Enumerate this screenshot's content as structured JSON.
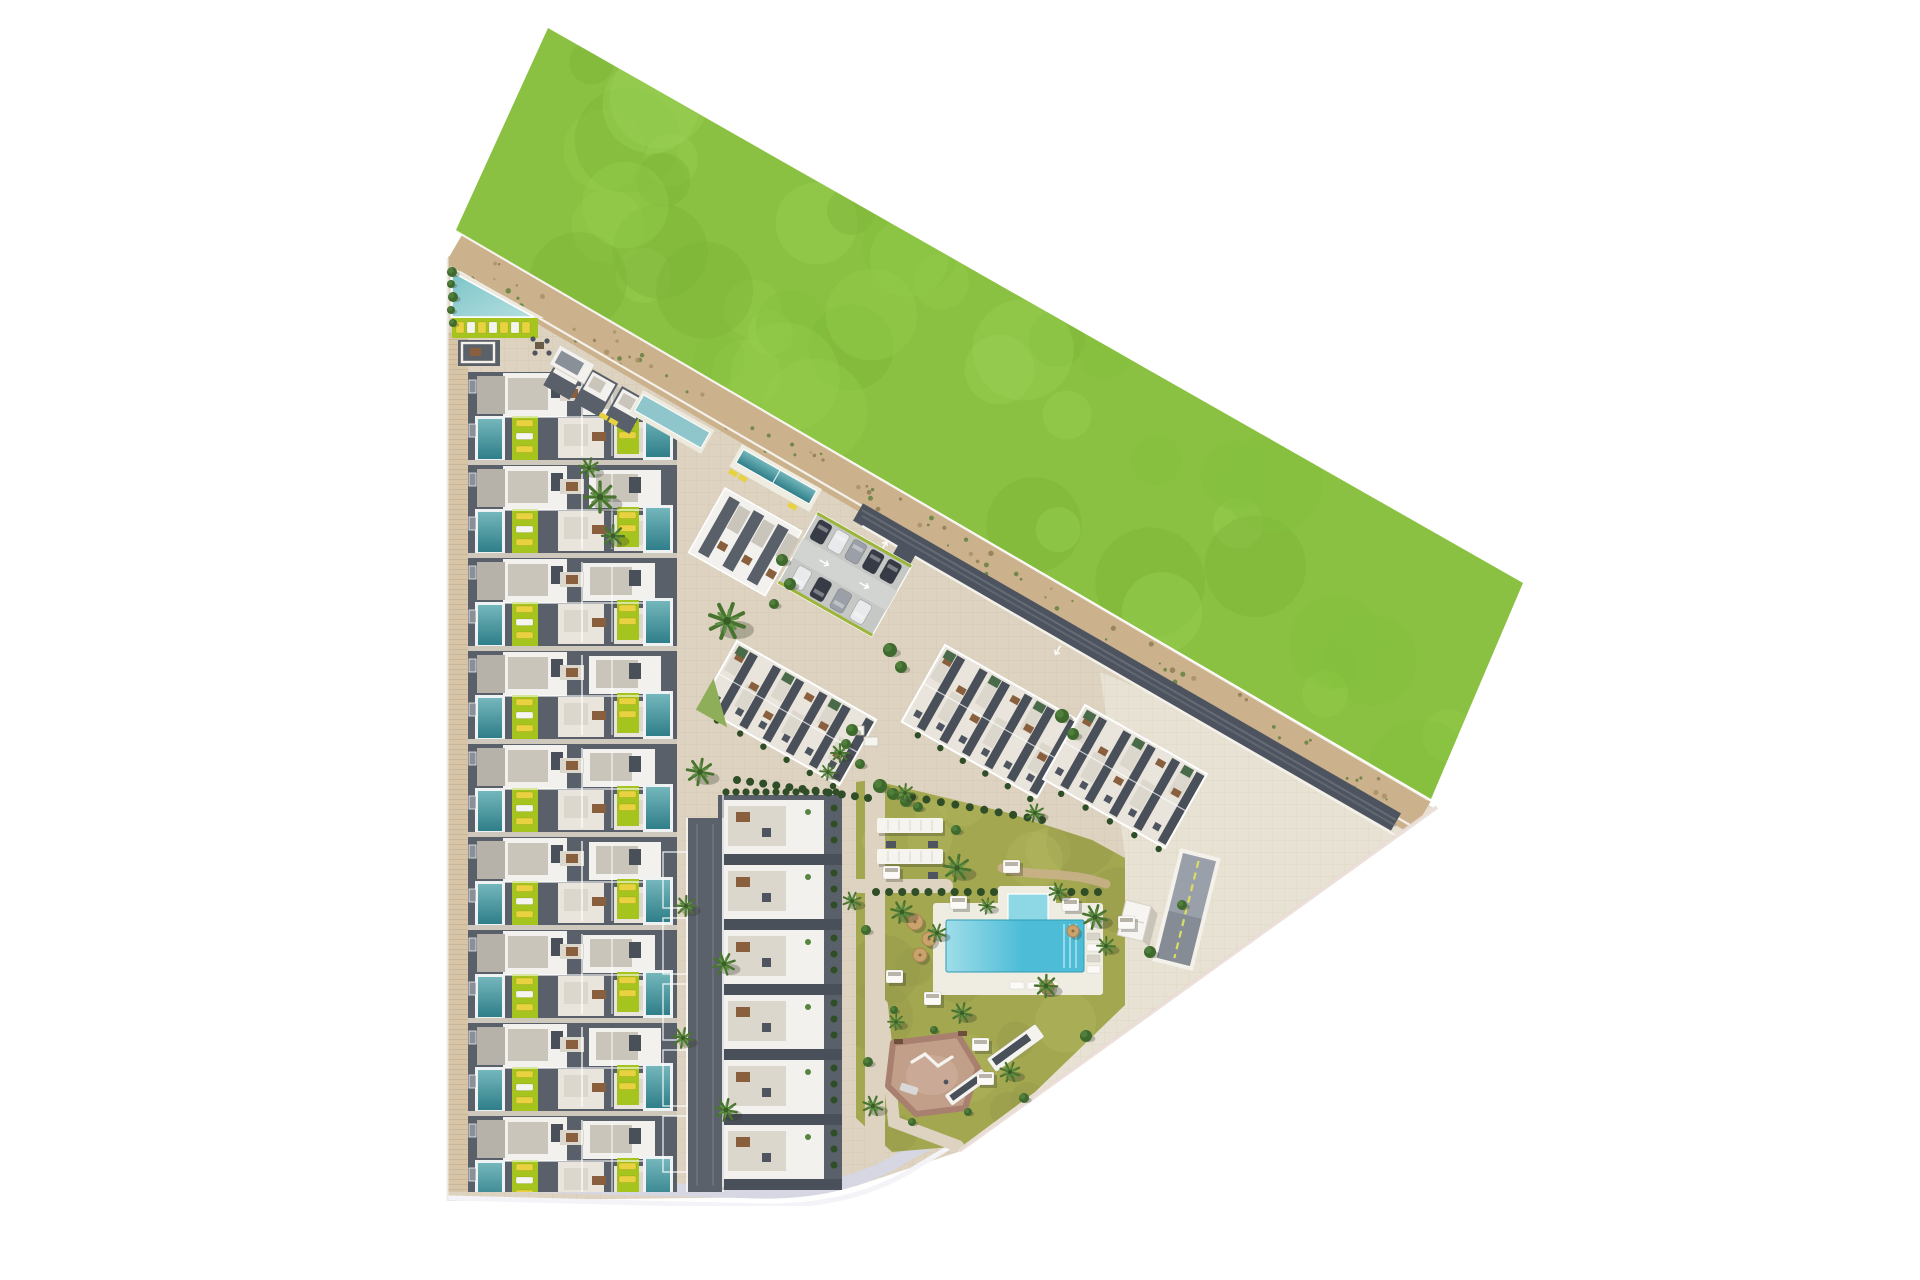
{
  "meta": {
    "title": "residential-complex-aerial-site-plan-render",
    "canvas": {
      "w": 1920,
      "h": 1280
    }
  },
  "colors": {
    "white": "#ffffff",
    "plaza": "#ddd3c0",
    "pavement_light": "#e8e2d4",
    "sidewalk": "#d8c5a7",
    "grass_base": "#8ac142",
    "grass_light": "#9bd157",
    "grass_light2": "#95cc4d",
    "grass_dark": "#7cb437",
    "grass_dark2": "#83bf3d",
    "sand": "#cbb28c",
    "speckle1": "#8d7c55",
    "speckle2": "#64803f",
    "speckle3": "#a98f66",
    "road_dark": "#4e545f",
    "road_streak": "#7a8088",
    "bottom_road": "#d6d7e2",
    "edge_pink": "#e9dbd4",
    "roof_white": "#f2f1ee",
    "roof_white_warm": "#e9e5dc",
    "terrace": "#cac5bb",
    "terrace_light": "#dbd7cd",
    "dark_roof": "#596069",
    "dark_roof2": "#4a505a",
    "mid_gray": "#8a9098",
    "pool_teal": "#2f7e89",
    "pool_teal_light": "#74b7bc",
    "pool_corner": "#8ec6cc",
    "lime": "#a6c41e",
    "lounger_yellow": "#e8d23f",
    "brown": "#8a5f3d",
    "table_dark": "#4f5560",
    "hedge": "#2f4d26",
    "bush": "#3f6a2e",
    "bush_light": "#558540",
    "palm": "#49742f",
    "palm_light": "#5d8f45",
    "palm_core": "#3a5c26",
    "lawn_base": "#a3a750",
    "lawn_light": "#b4ba62",
    "lawn_dark": "#93994a",
    "pool_main": "#4dbdd7",
    "pool_main_light": "#9fdde9",
    "pool_kids": "#8ed8e6",
    "deck": "#efece2",
    "pg_fill": "#c29f89",
    "pg_rim": "#a97f6f",
    "pg_inner": "#cdaf9b",
    "car_dark": "#363b46",
    "car_white": "#e8eaec",
    "car_silver": "#9ba0a8",
    "parasol": "#c9a36b",
    "ramp_surface": "#9aa0aa",
    "ramp_line": "#d8df63",
    "wall_white": "#f4f1ea",
    "parking_base": "#c6c8c6",
    "parking_aisle": "#d2d4d2",
    "curb_lime": "#9cb437",
    "shadow": "rgba(45,50,40,0.28)"
  },
  "site": {
    "interior_pts": "448,256 1437,810 958,1152 898,1172 856,1186 778,1197 448,1201",
    "pavement_right_pts": "1100,672 1437,810 958,1152 1125,1005 1125,855",
    "grass_pts": "548,28 1523,583 1431,799 456,230",
    "grass_par": {
      "ax": 548,
      "ay": 28,
      "abx": 975,
      "aby": 555,
      "adx": -92,
      "ady": 202
    },
    "sand": {
      "x1": 452,
      "y1": 252,
      "x2": 1421,
      "y2": 818,
      "w": 38
    },
    "sand_top": {
      "x1": 456,
      "y1": 231,
      "x2": 1428,
      "y2": 800
    },
    "road": {
      "x1": 858,
      "y1": 512,
      "x2": 1396,
      "y2": 822,
      "w": 20
    },
    "white_top": {
      "x1": 460,
      "y1": 272,
      "x2": 1415,
      "y2": 828
    },
    "white_bottom": {
      "x1": 862,
      "y1": 526,
      "x2": 1400,
      "y2": 838
    },
    "diag": {
      "x1": 1437,
      "y1": 807,
      "x2": 959,
      "y2": 1151
    },
    "bottom_road_d": "M448,1184 L758,1192 Q848,1194 908,1154 L950,1132",
    "bottom_white_d": "M448,1198 L762,1206 Q856,1207 918,1166 L958,1142",
    "outside_right_pts": "1437,806 958,1152 940,1280 1920,1280 1920,806"
  },
  "townhouses": {
    "x": 468,
    "w": 209,
    "first_y": 372,
    "pitch": 93,
    "rows": 9,
    "clip": "448,292 677,420 677,1192 448,1192",
    "sidewalk": [
      448,
      332,
      20,
      860
    ]
  },
  "corner_units": [
    [
      562,
      352
    ],
    [
      592,
      369
    ],
    [
      622,
      386
    ]
  ],
  "corner_pool": {
    "tx": 643,
    "ty": 390,
    "rot": 29.5,
    "w": 82,
    "h": 27
  },
  "corner_loungers": {
    "tx": 601,
    "ty": 412,
    "rot": 29.5
  },
  "communal": {
    "deck_pts": "450,266 544,318 450,318",
    "pool_pts": "452,272 534,317 452,317",
    "lawn": [
      452,
      318,
      86,
      20
    ],
    "loungers": 7,
    "patio": [
      458,
      340,
      42,
      26
    ],
    "seating": [
      530,
      336
    ],
    "hut": {
      "tx": 560,
      "ty": 345,
      "rot": 29.5,
      "w": 40,
      "h": 22
    }
  },
  "m2": {
    "x": 722,
    "y": 795,
    "w": 118,
    "h": 392,
    "segs": 6,
    "pitch": 65
  },
  "mid_road": {
    "x": 688,
    "y": 818,
    "w": 34,
    "h": 374,
    "bays": 5
  },
  "m1": {
    "tx": 725,
    "ty": 488,
    "rot": 29.5,
    "w": 88,
    "h": 74,
    "stripes": 3
  },
  "m1_pool": {
    "tx": 742,
    "ty": 444,
    "rot": 29.5,
    "w": 92,
    "h": 26
  },
  "blocks": [
    {
      "name": "apartment-block-a",
      "tx": 737,
      "ty": 641,
      "rot": 29.5,
      "w": 160,
      "h": 75,
      "stripes": 6,
      "cut": true
    },
    {
      "name": "apartment-block-b",
      "tx": 945,
      "ty": 645,
      "rot": 29.5,
      "w": 155,
      "h": 88,
      "stripes": 6,
      "cut": false
    },
    {
      "name": "apartment-block-c",
      "tx": 1085,
      "ty": 705,
      "rot": 29.5,
      "w": 140,
      "h": 85,
      "stripes": 5,
      "cut": false
    }
  ],
  "parking": {
    "tx": 818,
    "ty": 512,
    "rot": 29.5,
    "w": 108,
    "h": 82,
    "rows": [
      [
        "dark",
        "white",
        "silver",
        "dark",
        "dark"
      ],
      [
        "white",
        "dark",
        "silver",
        "white"
      ]
    ]
  },
  "lawn": {
    "pts": "872,780 1005,812 1092,840 1125,858 1125,1005 1035,1092 962,1146 892,1152 856,1118 856,782",
    "paths": [
      {
        "d": "M875,762 L875,1148",
        "w": 20
      },
      {
        "d": "M856,886 L946,886",
        "w": 14
      },
      {
        "d": "M882,1005 L894,1122 L958,1146",
        "w": 12
      }
    ],
    "dirt": {
      "d": "M1002,868 C1040,878 1066,870 1106,884",
      "w": 9
    }
  },
  "hedges": [
    {
      "x1": 737,
      "y1": 780,
      "x2": 868,
      "y2": 798,
      "n": 11
    },
    {
      "x1": 912,
      "y1": 797,
      "x2": 1042,
      "y2": 820,
      "n": 10
    },
    {
      "x1": 876,
      "y1": 892,
      "x2": 994,
      "y2": 892,
      "n": 10
    },
    {
      "x1": 1058,
      "y1": 892,
      "x2": 1098,
      "y2": 892,
      "n": 4
    }
  ],
  "pergolas": [
    [
      877,
      818,
      66,
      15
    ],
    [
      877,
      849,
      66,
      15
    ]
  ],
  "pergola_tables": [
    [
      886,
      841
    ],
    [
      928,
      841
    ],
    [
      886,
      872
    ],
    [
      928,
      872
    ]
  ],
  "planters": [
    [
      850,
      726
    ],
    [
      864,
      737
    ]
  ],
  "main_pool": {
    "deck": [
      933,
      903,
      170,
      92
    ],
    "ext": [
      998,
      886,
      58,
      30
    ],
    "main": [
      946,
      920,
      138,
      52
    ],
    "kids": [
      1008,
      894,
      40,
      28
    ],
    "loungers_right": 5,
    "loungers_bottom": 3
  },
  "playground": {
    "pts": "893,1043 958,1035 978,1068 965,1108 916,1114 888,1086",
    "inner": [
      932,
      1075,
      26,
      20
    ]
  },
  "ramp": {
    "tx": 1183,
    "ty": 853,
    "rot": 14,
    "w": 34,
    "h": 108
  },
  "hut": {
    "tx": 1126,
    "ty": 900,
    "rot": 14,
    "w": 26,
    "h": 36
  },
  "bench_pergolas": [
    {
      "tx": 996,
      "ty": 1072,
      "rot": -36,
      "l": 60,
      "h": 16
    },
    {
      "tx": 952,
      "ty": 1106,
      "rot": -36,
      "l": 46,
      "h": 13
    }
  ],
  "cabanas": [
    [
      883,
      866
    ],
    [
      1003,
      860
    ],
    [
      950,
      896
    ],
    [
      1062,
      898
    ],
    [
      886,
      970
    ],
    [
      924,
      992
    ],
    [
      1118,
      916
    ],
    [
      972,
      1038
    ],
    [
      977,
      1072
    ]
  ],
  "parasols": [
    [
      915,
      922,
      8
    ],
    [
      929,
      939,
      7
    ],
    [
      920,
      955,
      7
    ],
    [
      1047,
      987,
      7
    ],
    [
      1073,
      931,
      6
    ]
  ],
  "palms": [
    [
      600,
      497,
      15
    ],
    [
      613,
      536,
      11
    ],
    [
      589,
      468,
      10
    ],
    [
      727,
      621,
      18
    ],
    [
      700,
      772,
      13
    ],
    [
      686,
      906,
      10
    ],
    [
      724,
      964,
      11
    ],
    [
      683,
      1038,
      10
    ],
    [
      726,
      1110,
      11
    ],
    [
      852,
      901,
      9
    ],
    [
      905,
      793,
      9
    ],
    [
      1035,
      813,
      9
    ],
    [
      957,
      868,
      13
    ],
    [
      987,
      906,
      8
    ],
    [
      902,
      912,
      11
    ],
    [
      937,
      933,
      9
    ],
    [
      1058,
      892,
      9
    ],
    [
      1095,
      917,
      12
    ],
    [
      1106,
      946,
      9
    ],
    [
      962,
      1013,
      10
    ],
    [
      873,
      1106,
      10
    ],
    [
      1010,
      1072,
      10
    ],
    [
      1046,
      986,
      11
    ],
    [
      840,
      753,
      9
    ],
    [
      828,
      772,
      8
    ],
    [
      896,
      1022,
      8
    ]
  ],
  "bushes": [
    [
      452,
      272,
      5
    ],
    [
      451,
      284,
      4
    ],
    [
      453,
      297,
      5
    ],
    [
      451,
      310,
      4
    ],
    [
      453,
      323,
      4
    ],
    [
      890,
      650,
      7
    ],
    [
      901,
      667,
      6
    ],
    [
      1062,
      716,
      7
    ],
    [
      1073,
      734,
      6
    ],
    [
      782,
      560,
      6
    ],
    [
      790,
      584,
      6
    ],
    [
      774,
      604,
      5
    ],
    [
      880,
      786,
      7
    ],
    [
      893,
      794,
      6
    ],
    [
      906,
      801,
      6
    ],
    [
      918,
      807,
      5
    ],
    [
      852,
      730,
      6
    ],
    [
      846,
      744,
      5
    ],
    [
      860,
      764,
      5
    ],
    [
      1150,
      952,
      6
    ],
    [
      1086,
      1036,
      6
    ],
    [
      1024,
      1098,
      5
    ],
    [
      866,
      930,
      5
    ],
    [
      868,
      1062,
      5
    ],
    [
      894,
      1010,
      4
    ],
    [
      956,
      830,
      5
    ],
    [
      934,
      1030,
      4
    ],
    [
      968,
      1112,
      4
    ],
    [
      912,
      1122,
      4
    ],
    [
      1182,
      905,
      5
    ]
  ],
  "arrows": [
    [
      884,
      546,
      29.5
    ],
    [
      1058,
      650,
      209.5
    ]
  ],
  "random": {
    "grass_blobs": 48,
    "lawn_blobs": 20,
    "sand_speckles": 95,
    "seed": 13
  }
}
